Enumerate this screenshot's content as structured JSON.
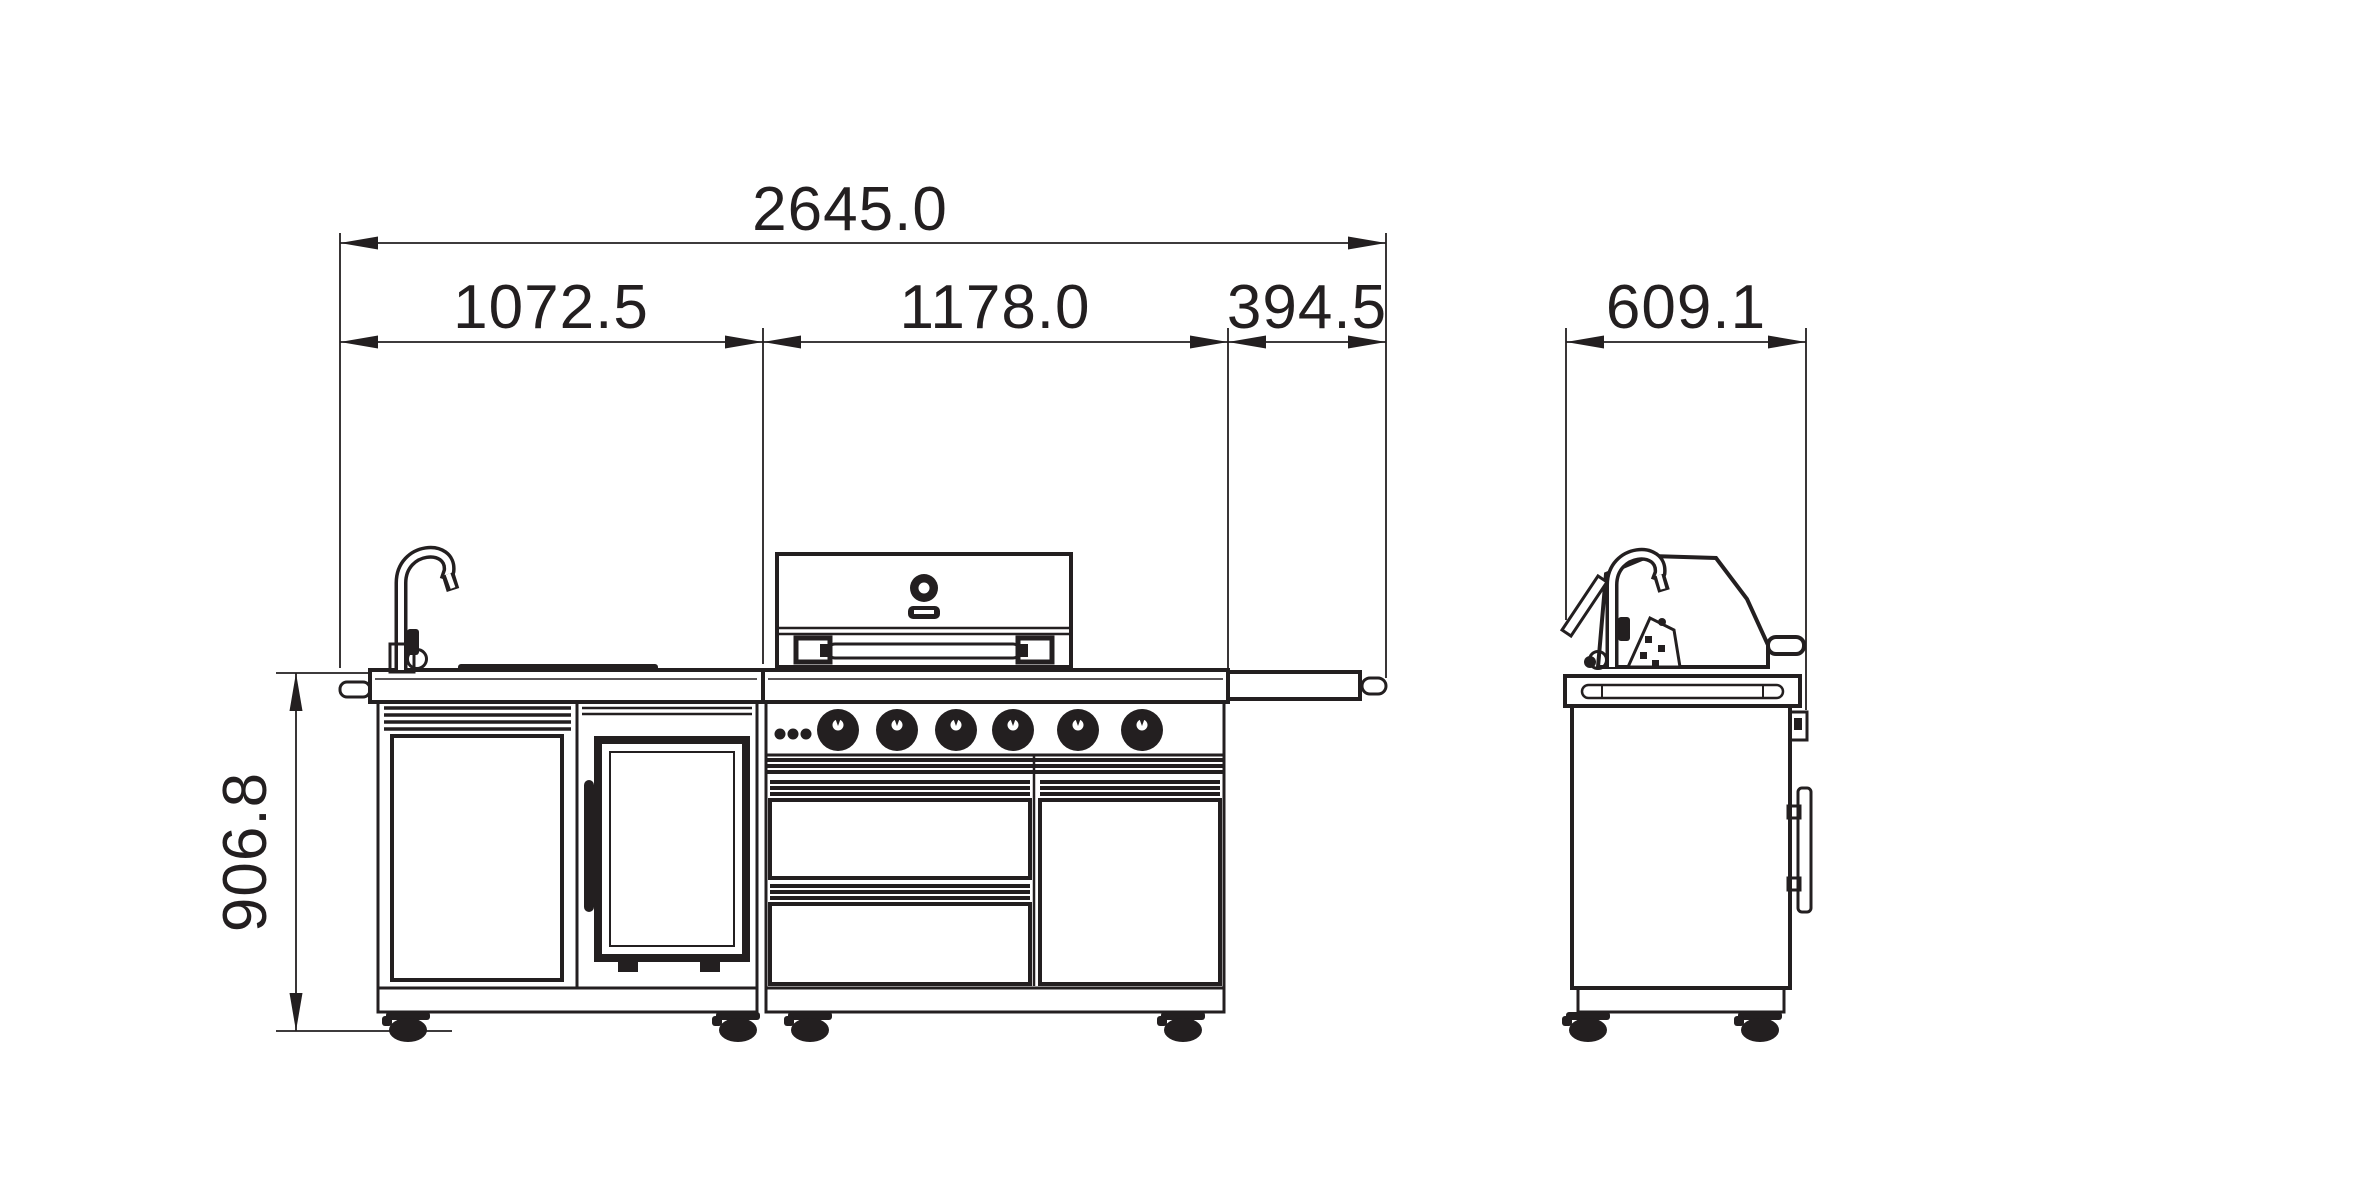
{
  "colors": {
    "line": "#231f20",
    "background": "#ffffff"
  },
  "dimensions": {
    "overall_width": "2645.0",
    "left_module_width": "1072.5",
    "grill_module_width": "1178.0",
    "side_shelf_width": "394.5",
    "depth": "609.1",
    "height": "906.8"
  }
}
